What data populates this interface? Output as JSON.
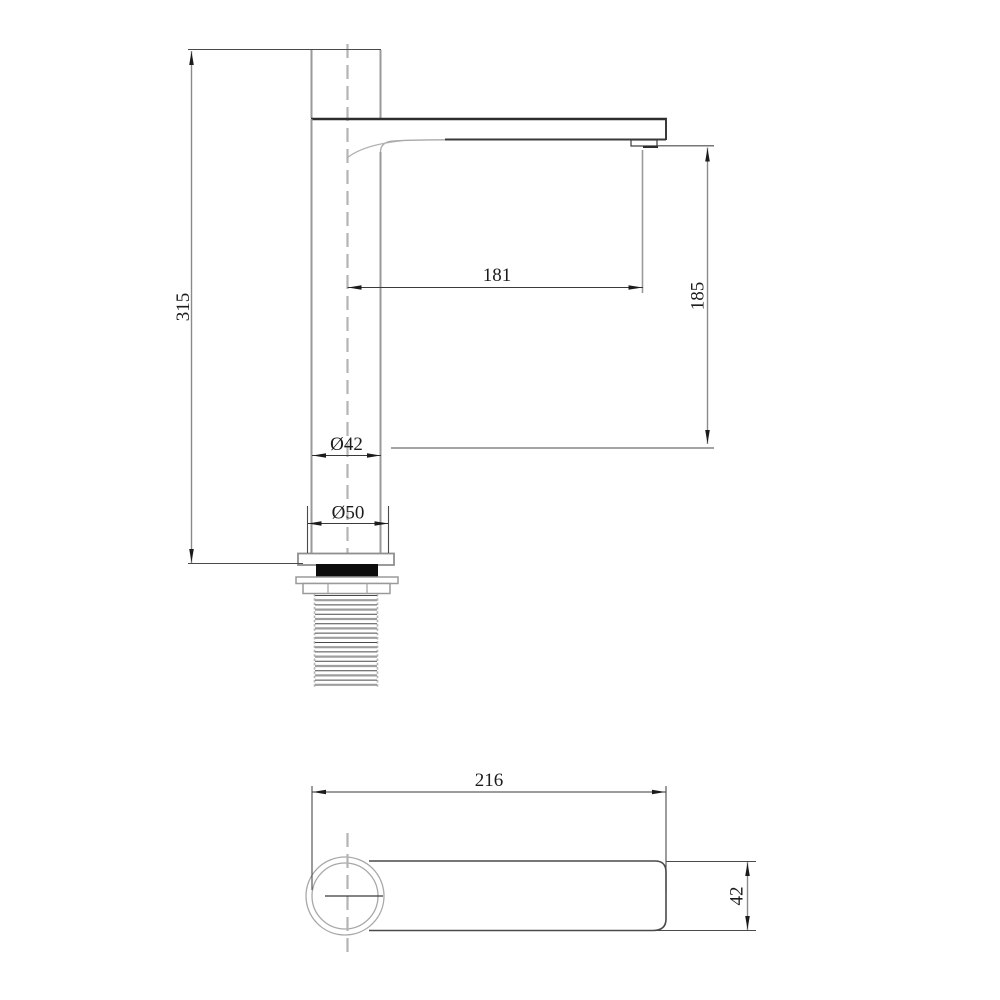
{
  "front": {
    "height": "315",
    "spout_reach": "181",
    "spout_height": "185",
    "body_diameter": "Ø42",
    "base_diameter": "Ø50"
  },
  "top": {
    "overall_length": "216",
    "spout_width": "42"
  },
  "colors": {
    "background": "#ffffff",
    "outline_dark": "#3a3a3a",
    "outline_gray": "#9a9a9a",
    "centerline_gray": "#b4b4b4",
    "dimension_text": "#1c1c1c",
    "gasket": "#0d0d0d"
  }
}
